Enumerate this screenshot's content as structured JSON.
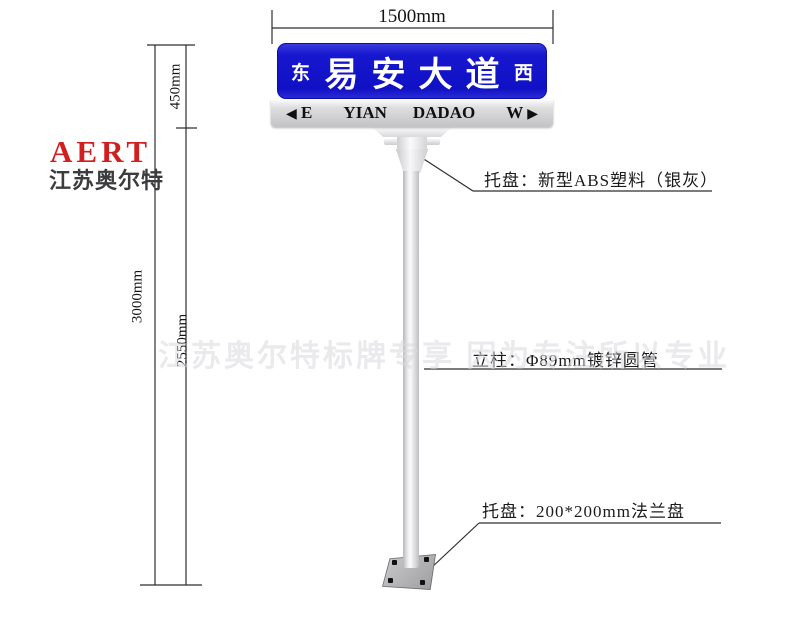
{
  "brand": {
    "logo": "AERT",
    "subtitle": "江苏奥尔特"
  },
  "dimensions": {
    "sign_width": "1500mm",
    "panel_height": "450mm",
    "total_height": "3000mm",
    "pole_height": "2550mm"
  },
  "sign": {
    "left_char": "东",
    "road_name": "易安大道",
    "right_char": "西",
    "band": {
      "left_arrow": "◀",
      "left_letter": "E",
      "word1": "YIAN",
      "word2": "DADAO",
      "right_letter": "W",
      "right_arrow": "▶"
    }
  },
  "labels": {
    "bracket_top": "托盘：新型ABS塑料（银灰）",
    "pole": "立柱：Φ89mm镀锌圆管",
    "base": "托盘：200*200mm法兰盘"
  },
  "watermark": "江苏奥尔特标牌专享 因为专注所以专业",
  "colors": {
    "sign_blue": "#1212C8",
    "brand_red": "#D11F1F",
    "band_gray": "#C6C6C9",
    "pole_silver": "#E9E9EB",
    "flange_gray": "#B2B2B5"
  }
}
